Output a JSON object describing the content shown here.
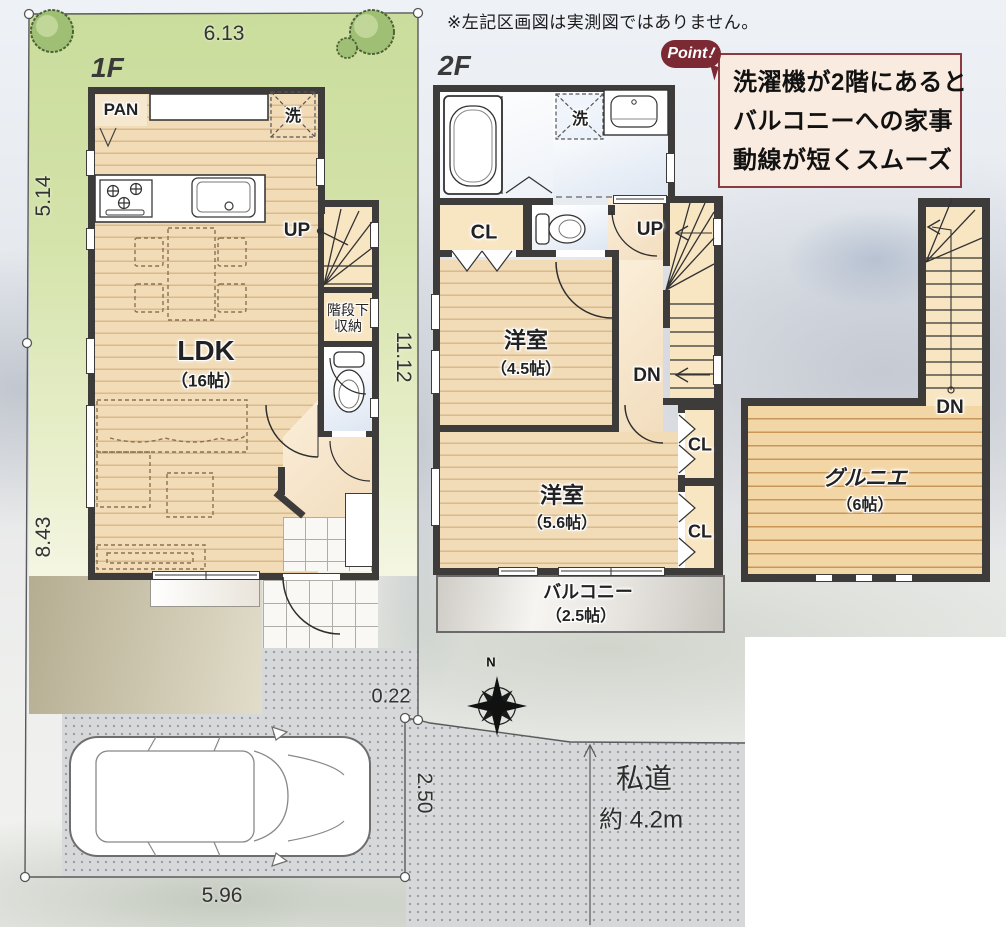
{
  "disclaimer": "※左記区画図は実測図ではありません。",
  "point": {
    "badge": "Point",
    "lines": [
      "洗濯機が2階にあると",
      "バルコニーへの家事",
      "動線が短くスムーズ"
    ]
  },
  "floors": {
    "f1": "1F",
    "f2": "2F"
  },
  "labels": {
    "up": "UP",
    "dn": "DN",
    "cl": "CL",
    "wash": "洗",
    "pan": "PAN",
    "stair_storage_line1": "階段下",
    "stair_storage_line2": "収納"
  },
  "rooms": {
    "ldk": {
      "name": "LDK",
      "size": "（16帖）"
    },
    "bed45": {
      "name": "洋室",
      "size": "（4.5帖）"
    },
    "bed56": {
      "name": "洋室",
      "size": "（5.6帖）"
    },
    "balcony": {
      "name": "バルコニー",
      "size": "（2.5帖）"
    },
    "loft": {
      "name": "グルニエ",
      "size": "（6帖）"
    }
  },
  "dimensions": {
    "lot_width_top": "6.13",
    "lot_left_upper": "5.14",
    "lot_left_lower": "8.43",
    "lot_right": "11.12",
    "corner_offset": "0.22",
    "parking_depth": "2.50",
    "parking_width": "5.96"
  },
  "road": {
    "name": "私道",
    "width": "約 4.2m"
  },
  "compass": {
    "north": "N"
  },
  "colors": {
    "wall": "#3e3b3b",
    "floor": "#f2dcb7",
    "lot_green": "#d2e2a7",
    "point_accent": "#7b2a33",
    "point_bg": "#f9ebdf"
  }
}
